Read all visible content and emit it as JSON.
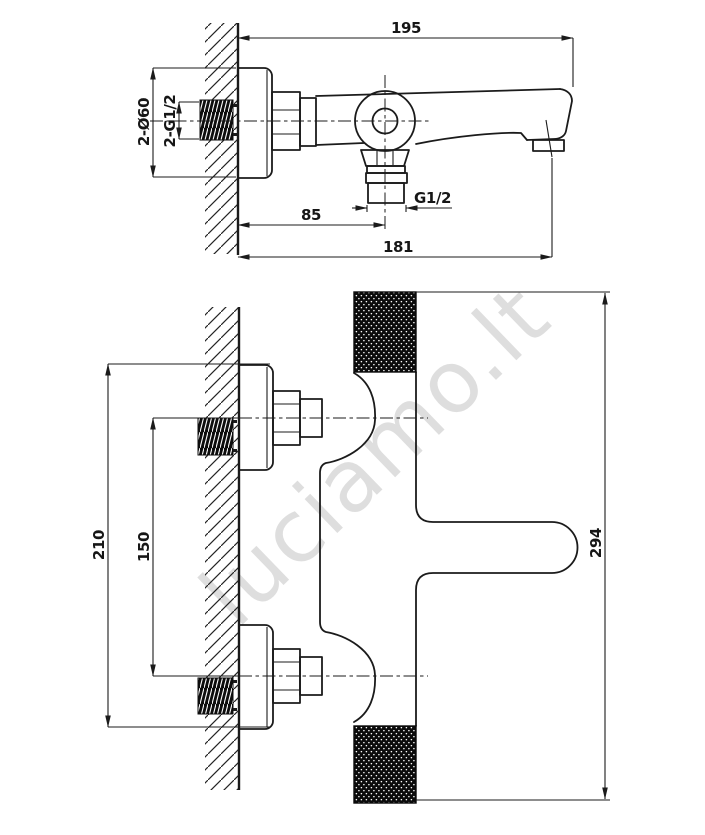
{
  "page": {
    "background": "#ffffff",
    "line_color": "#1b1b1b"
  },
  "watermark": {
    "text": "luciamo.lt",
    "color": "#d2d2d2"
  },
  "side_view": {
    "dims": {
      "overall_depth": "195",
      "escutcheons": "2-Ø60",
      "wall_threads": "2-G1/2",
      "outlet_thread": "G1/2",
      "outlet_offset": "85",
      "spout_reach": "181"
    }
  },
  "front_view": {
    "dims": {
      "overall_escutcheons": "210",
      "inlet_centers": "150",
      "body_length": "294"
    }
  }
}
